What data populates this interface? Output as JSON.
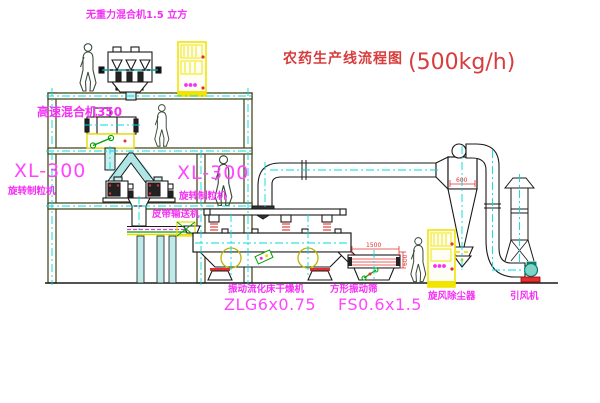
{
  "title": {
    "name": "农药生产线流程图",
    "capacity": "(500kg/h)"
  },
  "equipment_labels": {
    "gravity_mixer": "无重力混合机1.5 立方",
    "high_speed_mixer": "高速混合机350",
    "granulator_left": {
      "model": "XL-300",
      "name": "旋转制粒机"
    },
    "granulator_right": {
      "model": "XL-300",
      "name": "旋转制粒机"
    },
    "belt_conveyor": "皮带输送机",
    "fluid_bed_dryer": {
      "name": "振动流化床干燥机",
      "model": "ZLG6x0.75"
    },
    "square_sieve": {
      "name": "方形振动筛",
      "model": "FS0.6x1.5"
    },
    "cyclone": "旋风除尘器",
    "induced_draft_fan": "引风机"
  },
  "dimensions": {
    "sieve_length": "1500",
    "sieve_height": "600",
    "cyclone_diameter": "600"
  },
  "colors": {
    "label_magenta": "#f530f5",
    "title_red": "#d83c3c",
    "structure_olive": "#4a4a24",
    "centerline_cyan": "#00dcdc",
    "highlight_yellow": "#f2e400"
  }
}
